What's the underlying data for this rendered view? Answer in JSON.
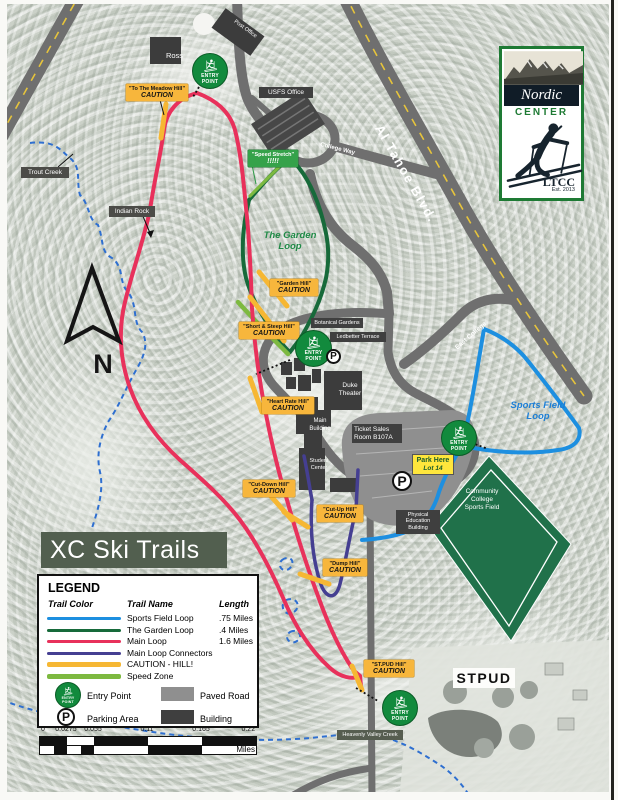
{
  "page": {
    "title": "XC Ski Trails"
  },
  "logo": {
    "nordic": "Nordic",
    "center": "CENTER",
    "ltcc": "LTCC",
    "est": "Est. 2013"
  },
  "legend": {
    "heading": "LEGEND",
    "col_color": "Trail Color",
    "col_name": "Trail Name",
    "col_length": "Length",
    "rows": [
      {
        "name": "Sports Field Loop",
        "length": ".75 Miles",
        "color": "#1d8fe0"
      },
      {
        "name": "The Garden Loop",
        "length": ".4 Miles",
        "color": "#176a3a"
      },
      {
        "name": "Main Loop",
        "length": "1.6 Miles",
        "color": "#e8315b"
      },
      {
        "name": "Main Loop Connectors",
        "length": "",
        "color": "#453f92"
      },
      {
        "name": "CAUTION - HILL!",
        "length": "",
        "color": "#f6b733"
      },
      {
        "name": "Speed Zone",
        "length": "",
        "color": "#7db940"
      }
    ],
    "entry_point": "Entry Point",
    "parking_area": "Parking Area",
    "paved_road": "Paved Road",
    "building": "Building"
  },
  "scalebar": {
    "ticks": [
      "0",
      "0.0275",
      "0.055",
      "0.11",
      "0.165",
      "0.22"
    ],
    "unit": "Miles"
  },
  "roads": {
    "al_tahoe": "Al Tahoe Blvd.",
    "college_way": "College Way",
    "east_college": "East College"
  },
  "places": {
    "trout_creek": "Trout Creek",
    "indian_rock": "Indian Rock",
    "garden_l1": "The Garden",
    "garden_l2": "Loop",
    "sports_l1": "Sports Field",
    "sports_l2": "Loop",
    "stpud": "STPUD",
    "heavenly": "Heavenly Valley Creek",
    "north": "N"
  },
  "buildings": {
    "ross": "Ross",
    "post_office": "Post Office",
    "usfs": "USFS Office",
    "botanical": "Botanical Gardens",
    "ledbetter": "Ledbetter Terrace",
    "duke_l1": "Duke",
    "duke_l2": "Theater",
    "main_l1": "Main",
    "main_l2": "Building",
    "ticket_l1": "Ticket Sales",
    "ticket_l2": "Room B107A",
    "student_l1": "Student",
    "student_l2": "Center",
    "pe_l1": "Physical",
    "pe_l2": "Education",
    "pe_l3": "Building",
    "field_l1": "Community",
    "field_l2": "College",
    "field_l3": "Sports Field"
  },
  "cautions": {
    "word": "CAUTION",
    "meadow": {
      "label": "\"To The Meadow Hill\""
    },
    "garden": {
      "label": "\"Garden Hill\""
    },
    "short_steep": {
      "label": "\"Short & Steep Hill\""
    },
    "heart": {
      "label": "\"Heart Rate Hill\""
    },
    "cut_down": {
      "label": "\"Cut-Down Hill\""
    },
    "cut_up": {
      "label": "\"Cut-Up Hill\""
    },
    "dump": {
      "label": "\"Dump Hill\""
    },
    "stpud": {
      "label": "\"ST.PUD Hill\""
    }
  },
  "speed_zone_label": {
    "label": "\"Speed Stretch\"",
    "marks": "!!!!!"
  },
  "park_here": {
    "l1": "Park Here",
    "l2": "Lot 14"
  },
  "entry_marker": {
    "l1": "ENTRY",
    "l2": "POINT"
  },
  "parking_marker": {
    "letter": "P"
  },
  "colors": {
    "sports_loop": "#1d8fe0",
    "garden_loop": "#176a3a",
    "main_loop": "#e8315b",
    "connectors": "#453f92",
    "caution": "#f6b733",
    "speed_zone": "#7db940",
    "paved_road": "#6f6f6f",
    "building": "#3f3f3f",
    "entry_green": "#128a3d",
    "caution_label_bg": "#f7b63c",
    "field_green": "#20714a"
  }
}
